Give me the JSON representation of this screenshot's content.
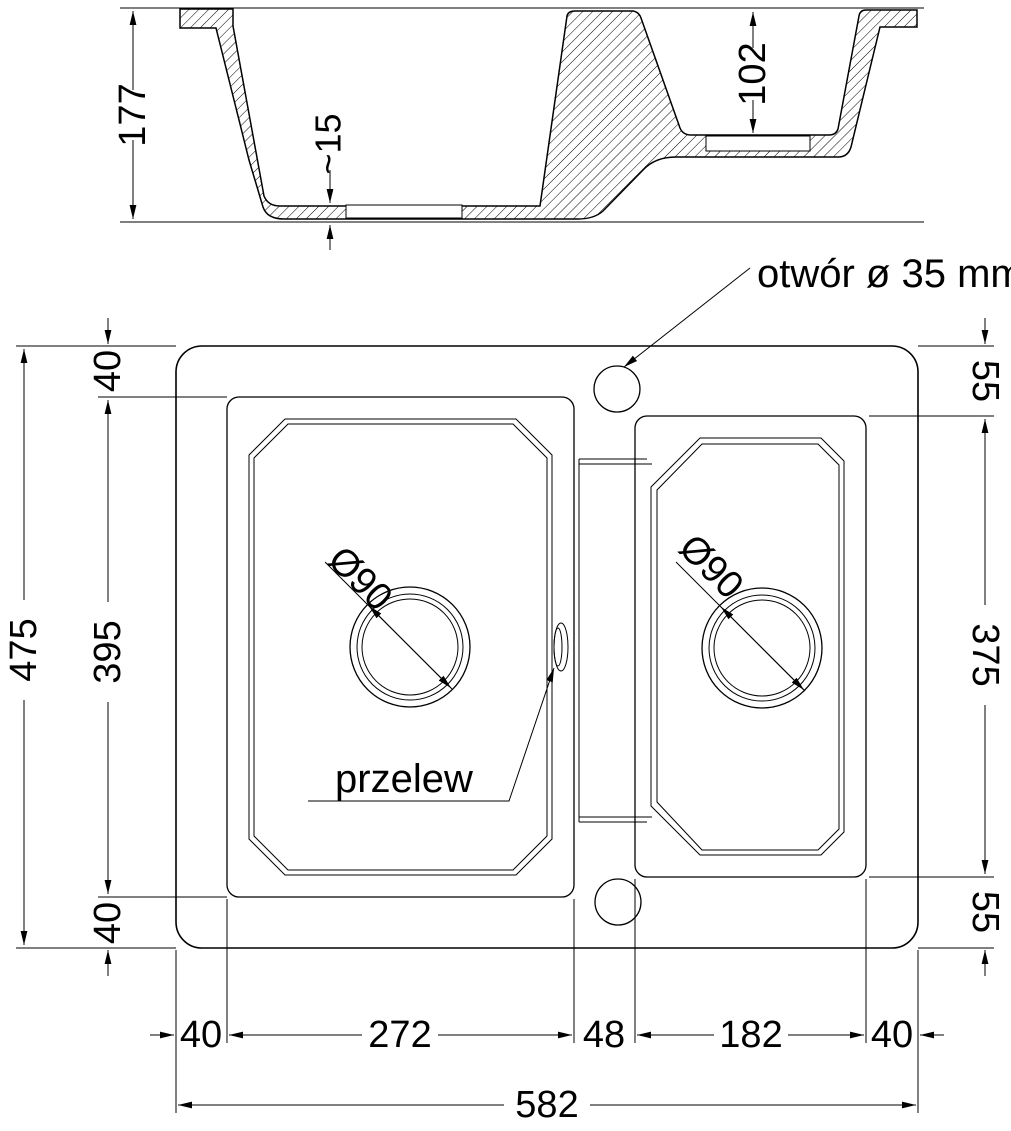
{
  "figure": {
    "cross_section": {
      "overall_depth": "177",
      "bottom_recess_depth": "~15",
      "small_bowl_depth": "102"
    },
    "top_view": {
      "tap_hole_label": "otwór ø 35 mm",
      "overflow_label": "przelew",
      "drain_left_diameter": "Ø90",
      "drain_right_diameter": "Ø90",
      "left_side": {
        "overall_height": "475",
        "bowl_height": "395",
        "offset_top": "40",
        "offset_bottom": "40"
      },
      "right_side": {
        "offset_top": "55",
        "bowl_height": "375",
        "offset_bottom": "55"
      },
      "bottom_row": {
        "margin_left": "40",
        "left_bowl_width": "272",
        "divider_width": "48",
        "right_bowl_width": "182",
        "margin_right": "40",
        "overall_width": "582"
      }
    },
    "line_color": "#000000",
    "background_color": "#ffffff"
  }
}
